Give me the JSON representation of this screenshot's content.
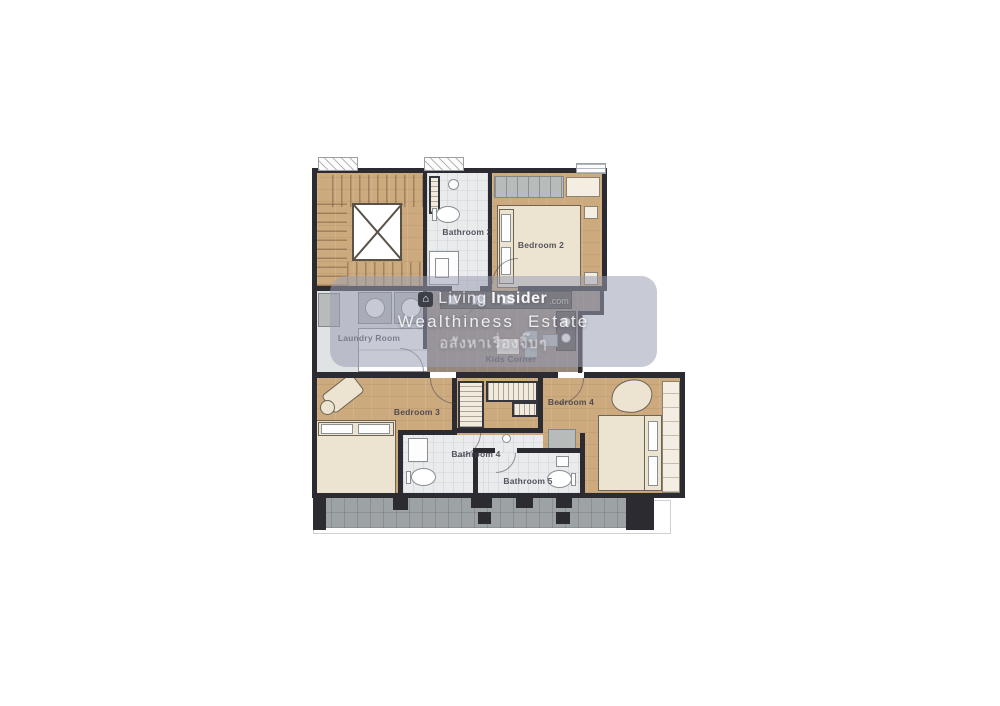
{
  "watermark": {
    "logo_icon": "house-logo-icon",
    "logo_glyph": "⌂",
    "brand_a": "Living",
    "brand_b": "Insider",
    "brand_suffix": ".com",
    "line2": "Wealthiness Estate",
    "line3": "อสังหาเรื่องจิ๊บๆ"
  },
  "rooms": {
    "bathroom_3": "Bathroom 3",
    "bedroom_2": "Bedroom 2",
    "laundry_room": "Laundry Room",
    "kids_corner": "Kids Corner",
    "bedroom_3": "Bedroom 3",
    "bedroom_4": "Bedroom 4",
    "bathroom_4": "Bathroom 4",
    "bathroom_5": "Bathroom 5"
  },
  "palette": {
    "wall": "#2b2b31",
    "wood_floor": "#cdaa7e",
    "living_floor": "#95887b",
    "bath_floor": "#e9ebed",
    "laundry_floor": "#e0e3e4",
    "bed_cream": "#ece4d0",
    "furniture_gray": "#b7bcba",
    "balcony_gray": "#9da2a5",
    "counter_dark": "#57504a",
    "watermark_tint": "#9a9eb2",
    "label_text": "#3f3f4b"
  }
}
